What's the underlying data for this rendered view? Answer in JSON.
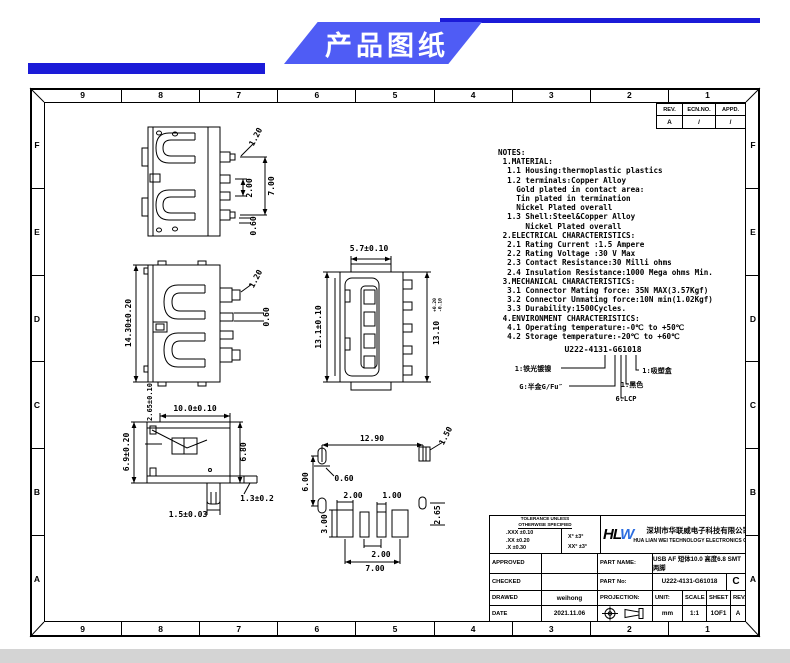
{
  "banner": {
    "title": "产品图纸"
  },
  "frame": {
    "cols": [
      "9",
      "8",
      "7",
      "6",
      "5",
      "4",
      "3",
      "2",
      "1"
    ],
    "rows": [
      "F",
      "E",
      "D",
      "C",
      "B",
      "A"
    ]
  },
  "rev_table": {
    "h0": "REV.",
    "h1": "ECN.NO.",
    "h2": "APPD.",
    "v0": "A",
    "v1": "/",
    "v2": "/"
  },
  "notes": {
    "text": "NOTES:\n 1.MATERIAL:\n  1.1 Housing:thermoplastic plastics\n  1.2 terminals:Copper Alloy\n    Gold plated in contact area:\n    Tin plated in termination\n    Nickel Plated overall\n  1.3 Shell:Steel&Copper Alloy\n      Nickel Plated overall\n 2.ELECTRICAL CHARACTERISTICS:\n  2.1 Rating Current :1.5 Ampere\n  2.2 Rating Voltage :30 V Max\n  2.3 Contact Resistance:30 Milli ohms\n  2.4 Insulation Resistance:1000 Mega ohms Min.\n 3.MECHANICAL CHARACTERISTICS:\n  3.1 Connector Mating force: 35N MAX(3.57Kgf)\n  3.2 Connector Unmating force:10N min(1.02Kgf)\n  3.3 Durability:1500Cycles.\n 4.ENVIRONMENT CHARACTERISTICS:\n  4.1 Operating temperature:-0℃ to +50℃\n  4.2 Storage temperature:-20℃ to +60℃"
  },
  "part_code": {
    "code": "U222-4131-G61018",
    "left1": "1:铁光镀镍",
    "left2": "G:半金G/Fu″",
    "right1": "1:吸塑盒",
    "right2": "1:黑色",
    "right3": "6:LCP"
  },
  "views": {
    "top": {
      "v120": "1.20",
      "v200": "2.00",
      "v700": "7.00",
      "v060": "0.60"
    },
    "front": {
      "v1430": "14.30±0.20",
      "v120": "1.20",
      "v060": "0.60"
    },
    "side": {
      "v265": "2.65±0.10",
      "v100": "10.0±0.10",
      "v690": "6.9±0.20",
      "v680": "6.80",
      "v150": "1.5±0.03",
      "v130": "1.3±0.2"
    },
    "profile": {
      "v570": "5.7±0.10",
      "v131": "13.1±0.10",
      "v1310": "13.10",
      "tp": "+0.20",
      "tm": "-0.10"
    },
    "footprint": {
      "v1290": "12.90",
      "v150": "1.50",
      "v060": "0.60",
      "v600": "6.00",
      "v200a": "2.00",
      "v100": "1.00",
      "v300": "3.00",
      "v200b": "2.00",
      "v700": "7.00",
      "v265": "2.65"
    }
  },
  "title_block": {
    "tolerance_header": "TOLERANCE UNLESS\nOTHERWISE SPECIFIED",
    "tol_linear": ".XXX ±0.10\n.XX  ±0.20\n.X   ±0.30",
    "tol_angle": "X°  ±3°\nXX° ±3°",
    "logo_black": "HL",
    "logo_blue": "W",
    "company_cn": "深圳市华联威电子科技有限公司",
    "company_en": "HUA LIAN WEI TECHNOLOGY ELECTRONICS CO;LTD.",
    "approved_label": "APPROVED",
    "checked_label": "CHECKED",
    "drawed_label": "DRAWED",
    "date_label": "DATE",
    "drawed_value": "weihong",
    "date_value": "2021.11.06",
    "part_name_label": "PART NAME:",
    "part_name": "USB AF 短体10.0 高度6.8 SMT 两脚",
    "part_no_label": "PART No:",
    "part_no": "U222-4131-G61018",
    "rev_letter": "C",
    "projection_label": "PROJECTION:",
    "unit_label": "UNIT:",
    "unit_value": "mm",
    "scale_label": "SCALE",
    "scale_value": "1:1",
    "sheet_label": "SHEET",
    "sheet_value": "1OF1",
    "rev_label": "REV.",
    "rev_value": "A"
  }
}
